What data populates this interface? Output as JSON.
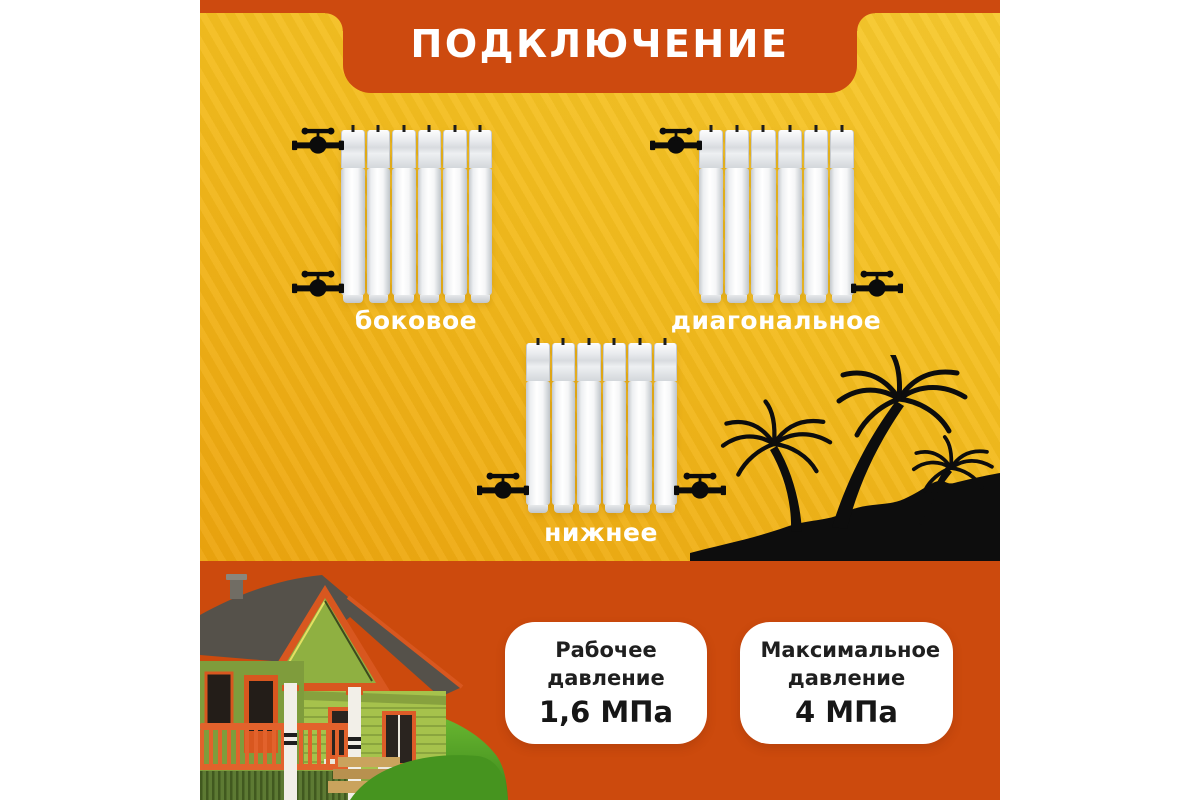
{
  "header": {
    "title": "ПОДКЛЮЧЕНИЕ"
  },
  "connection_types": [
    {
      "id": "side",
      "label": "боковое"
    },
    {
      "id": "diagonal",
      "label": "диагональное"
    },
    {
      "id": "bottom",
      "label": "нижнее"
    }
  ],
  "radiator": {
    "sections": 6
  },
  "specs": [
    {
      "label": "Рабочее давление",
      "value": "1,6 МПа"
    },
    {
      "label": "Максимальное давление",
      "value": "4 МПа"
    }
  ],
  "icons": {
    "valve": "shut-off-valve-icon",
    "palms": "palm-trees-silhouette",
    "house": "country-house-illustration"
  },
  "colors": {
    "orange": "#cd4a0f",
    "orange_bottom": "#cc4a0d",
    "yellow_top": "#f7c92e",
    "yellow_bottom": "#eda50e",
    "label_text": "#ffffff",
    "card_background": "#ffffff",
    "card_text": "#1f1f1f",
    "silhouette_black": "#0d0d0d"
  }
}
